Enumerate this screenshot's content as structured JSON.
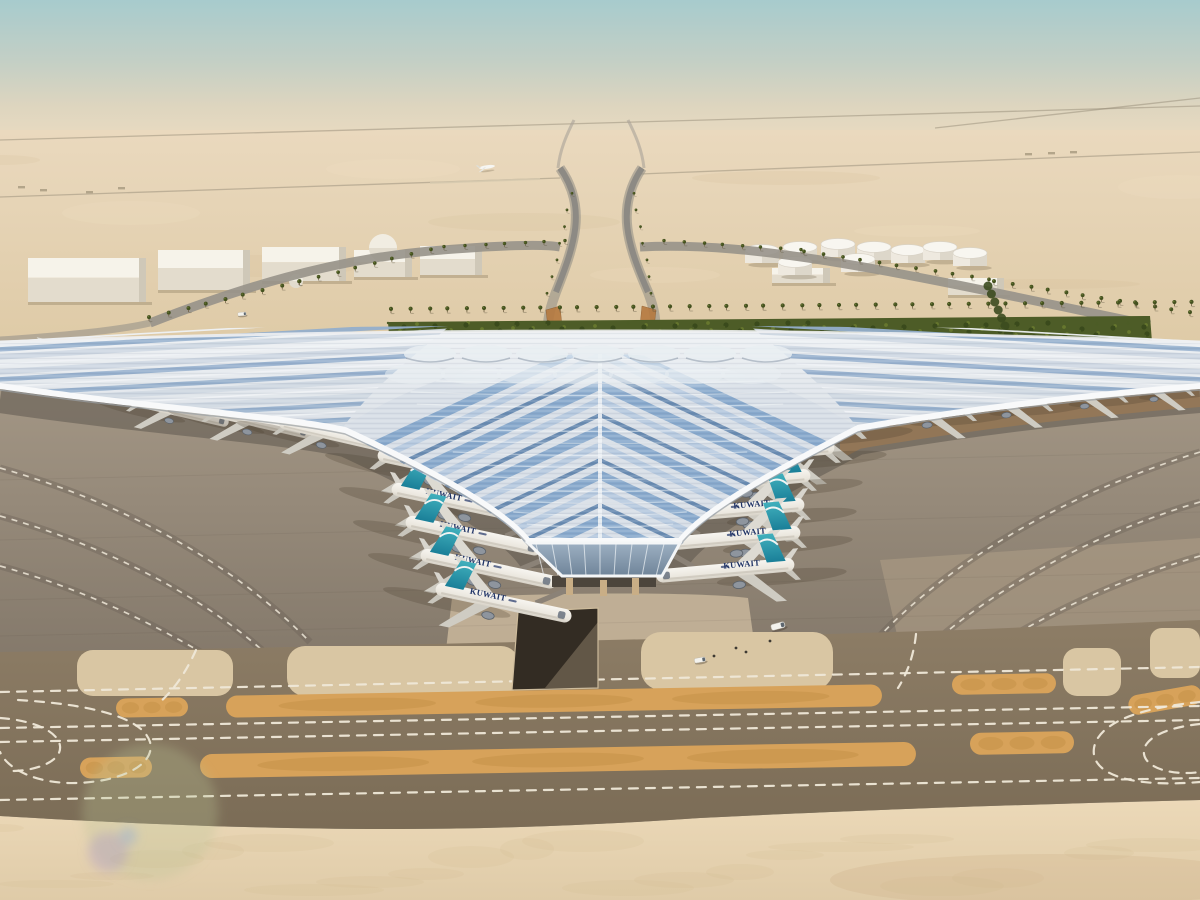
{
  "meta": {
    "title": "Aerial rendering of Kuwait International Airport new trefoil passenger terminal in the desert",
    "airline": "KUWAIT"
  },
  "colors": {
    "sky_top": "#a7cbcd",
    "sky_mid": "#c3cfc5",
    "horizon": "#e8dac0",
    "desert_far": "#ead9be",
    "desert_near": "#decaa6",
    "apron_top": "#a89b89",
    "apron_bottom": "#83786a",
    "taxiway_top": "#8d7d66",
    "taxiway_bottom": "#7b6c56",
    "sand_top": "#ecd9b8",
    "sand_bottom": "#dfcba8",
    "island_sand": "#d9c6a3",
    "orange_strip": "#d7a25a",
    "orange_strip_dark": "#b07f35",
    "marking_white": "#efe8d8",
    "roof_light": "#eef1f4",
    "roof_base": "#bfc9d4",
    "roof_blue": "#7fa3c9",
    "roof_blue_light": "#b3c7de",
    "roof_blue_dark": "#5d82ab",
    "fascia_white": "#f8f9fa",
    "glass_top": "#9db0c2",
    "glass_bottom": "#6f8499",
    "hedge_green": "#4d5c27",
    "palm_green": "#44511f",
    "trunk": "#6e5f42",
    "tail_teal": "#41b0bd",
    "tail_teal_dark": "#1a7f98",
    "fuselage_top": "#f7f5f0",
    "fuselage_belly": "#d6d1c6",
    "titles_navy": "#1f3366",
    "building_white": "#f6f3ea",
    "building_front": "#e3dccd",
    "building_shade": "#cfc8b8",
    "road_grey": "#97928a",
    "highway_grey": "#8d8a84",
    "ochre": "#b5793f",
    "shadow_cool": "#57514a",
    "shadow_warm": "#a97c49"
  },
  "desert_roads": [
    "M0,140 L1200,106",
    "M0,197 L560,178",
    "M640,174 L1200,152",
    "M935,128 L1200,98"
  ],
  "buildings": [
    {
      "x": 28,
      "y": 258,
      "w": 118,
      "h": 44
    },
    {
      "x": 158,
      "y": 250,
      "w": 92,
      "h": 40
    },
    {
      "x": 262,
      "y": 247,
      "w": 84,
      "h": 34
    },
    {
      "x": 354,
      "y": 250,
      "w": 58,
      "h": 27
    },
    {
      "x": 420,
      "y": 246,
      "w": 62,
      "h": 29
    },
    {
      "x": 772,
      "y": 268,
      "w": 58,
      "h": 15
    },
    {
      "x": 948,
      "y": 278,
      "w": 56,
      "h": 17
    }
  ],
  "domes": [
    {
      "x": 383,
      "y": 248,
      "r": 14
    },
    {
      "x": 296,
      "y": 281,
      "r": 7
    }
  ],
  "tanks": [
    {
      "x": 762,
      "y": 250
    },
    {
      "x": 800,
      "y": 247
    },
    {
      "x": 838,
      "y": 244
    },
    {
      "x": 874,
      "y": 247
    },
    {
      "x": 908,
      "y": 250
    },
    {
      "x": 940,
      "y": 247
    },
    {
      "x": 795,
      "y": 262
    },
    {
      "x": 858,
      "y": 259
    },
    {
      "x": 970,
      "y": 253
    }
  ],
  "palm_rows": [
    {
      "x1": 392,
      "y1": 313,
      "x2": 1192,
      "y2": 306,
      "n": 44,
      "s": 0.9
    },
    {
      "x1": 150,
      "y1": 321,
      "x2": 300,
      "y2": 285,
      "n": 9,
      "s": 0.85
    },
    {
      "x1": 300,
      "y1": 285,
      "x2": 430,
      "y2": 253,
      "n": 8,
      "s": 0.8
    },
    {
      "x1": 445,
      "y1": 250,
      "x2": 565,
      "y2": 244,
      "n": 7,
      "s": 0.75
    },
    {
      "x1": 665,
      "y1": 244,
      "x2": 800,
      "y2": 253,
      "n": 8,
      "s": 0.75
    },
    {
      "x1": 805,
      "y1": 255,
      "x2": 990,
      "y2": 283,
      "n": 11,
      "s": 0.8
    },
    {
      "x1": 995,
      "y1": 285,
      "x2": 1190,
      "y2": 316,
      "n": 12,
      "s": 0.85
    },
    {
      "x1": 548,
      "y1": 296,
      "x2": 572,
      "y2": 196,
      "n": 7,
      "s": 0.6
    },
    {
      "x1": 652,
      "y1": 296,
      "x2": 634,
      "y2": 196,
      "n": 7,
      "s": 0.6
    }
  ],
  "tree_cluster": {
    "x": 988,
    "y": 286,
    "n": 8
  },
  "hedge": {
    "x1": 388,
    "y1": 322,
    "x2": 1150,
    "y2": 316,
    "h": 26,
    "dots": 210
  },
  "planes": {
    "left_angle": 12,
    "right_angle": -5,
    "scale": 1.05,
    "left_column": [
      {
        "x": 386,
        "y": 456
      },
      {
        "x": 400,
        "y": 490
      },
      {
        "x": 414,
        "y": 523
      },
      {
        "x": 429,
        "y": 556
      },
      {
        "x": 444,
        "y": 590
      }
    ],
    "right_column": [
      {
        "x": 852,
        "y": 424
      },
      {
        "x": 826,
        "y": 448
      },
      {
        "x": 802,
        "y": 476
      },
      {
        "x": 796,
        "y": 505
      },
      {
        "x": 792,
        "y": 533
      },
      {
        "x": 786,
        "y": 565
      }
    ],
    "left_wing": [
      {
        "x": 30,
        "y": 360,
        "s": 0.7
      },
      {
        "x": 138,
        "y": 402,
        "s": 0.75
      },
      {
        "x": 214,
        "y": 412,
        "s": 0.8
      },
      {
        "x": 286,
        "y": 424,
        "s": 0.85
      }
    ],
    "right_wing": [
      {
        "x": 965,
        "y": 409,
        "s": 0.85
      },
      {
        "x": 1042,
        "y": 400,
        "s": 0.8
      },
      {
        "x": 1118,
        "y": 392,
        "s": 0.75
      },
      {
        "x": 1185,
        "y": 386,
        "s": 0.7
      }
    ]
  },
  "apron_arcs": [
    "M0,468 C120,502 230,560 310,642",
    "M0,516 C100,544 196,592 262,650",
    "M0,566 C80,588 150,622 204,654",
    "M1200,452 C1070,492 950,560 876,640",
    "M1200,502 C1090,534 990,592 930,646",
    "M1200,556 C1110,582 1040,618 986,652"
  ],
  "islands": [
    {
      "x": 77,
      "y": 650,
      "w": 156,
      "h": 46,
      "r": 16
    },
    {
      "x": 287,
      "y": 646,
      "w": 232,
      "h": 50,
      "r": 18
    },
    {
      "x": 641,
      "y": 632,
      "w": 192,
      "h": 58,
      "r": 20
    },
    {
      "x": 1063,
      "y": 648,
      "w": 58,
      "h": 48,
      "r": 14
    },
    {
      "x": 1150,
      "y": 628,
      "w": 50,
      "h": 50,
      "r": 12
    }
  ],
  "orange_strips": [
    {
      "x": 116,
      "y": 698,
      "w": 72,
      "h": 19,
      "a": -1
    },
    {
      "x": 226,
      "y": 690,
      "w": 656,
      "h": 22,
      "a": -1
    },
    {
      "x": 952,
      "y": 674,
      "w": 104,
      "h": 20,
      "a": -1
    },
    {
      "x": 80,
      "y": 757,
      "w": 72,
      "h": 21,
      "a": -1
    },
    {
      "x": 200,
      "y": 748,
      "w": 716,
      "h": 24,
      "a": -1
    },
    {
      "x": 970,
      "y": 732,
      "w": 104,
      "h": 22,
      "a": -1
    },
    {
      "x": 1128,
      "y": 690,
      "w": 74,
      "h": 20,
      "a": -10
    }
  ],
  "dash_paths": [
    "M0,692 L1200,667",
    "M0,728 L1200,706",
    "M0,742 L1200,720",
    "M0,800 L1200,778",
    "M18,700 C86,704 142,716 150,742 C156,766 118,782 76,783 C38,784 8,770 0,752",
    "M0,718 C30,720 58,730 60,746 C62,762 34,772 6,771",
    "M196,650 C188,668 176,688 160,702",
    "M588,645 C584,660 578,672 570,685",
    "M916,634 C914,654 908,672 898,688",
    "M1200,702 C1136,708 1098,724 1094,748 C1090,774 1130,788 1200,782",
    "M1200,724 C1162,728 1142,740 1144,754 C1146,768 1172,776 1200,772"
  ],
  "vehicles": [
    {
      "x": 778,
      "y": 626,
      "a": -15,
      "s": 1
    },
    {
      "x": 242,
      "y": 314,
      "a": -5,
      "s": 0.6
    },
    {
      "x": 700,
      "y": 660,
      "a": -10,
      "s": 0.8
    }
  ],
  "people": [
    [
      736,
      648
    ],
    [
      746,
      652
    ],
    [
      714,
      656
    ],
    [
      770,
      641
    ]
  ],
  "flares": [
    {
      "x": 150,
      "y": 812,
      "r": 68,
      "c": "rgba(184,196,150,0.30)"
    },
    {
      "x": 108,
      "y": 852,
      "r": 20,
      "c": "rgba(168,150,200,0.35)"
    },
    {
      "x": 128,
      "y": 836,
      "r": 9,
      "c": "rgba(140,170,220,0.40)"
    }
  ],
  "specks": [
    [
      18,
      186
    ],
    [
      40,
      189
    ],
    [
      86,
      191
    ],
    [
      118,
      187
    ],
    [
      1025,
      153
    ],
    [
      1048,
      152
    ],
    [
      1070,
      151
    ]
  ]
}
